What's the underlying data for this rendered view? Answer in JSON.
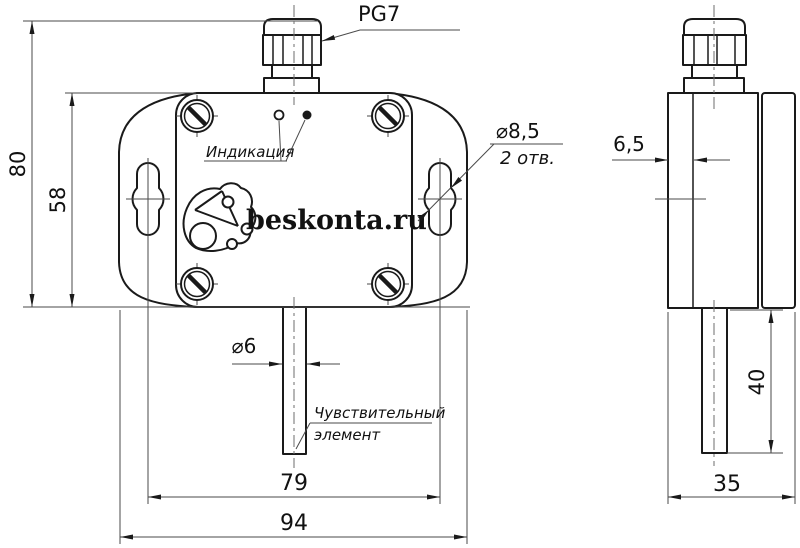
{
  "drawing": {
    "labels": {
      "cable_gland": "PG7",
      "indication": "Индикация",
      "logo_text": "beskonta.ru",
      "mount_hole_diameter": "⌀8,5",
      "mount_hole_count": "2 отв.",
      "probe_diameter": "⌀6",
      "sensing_element_line1": "Чувствительный",
      "sensing_element_line2": "элемент"
    },
    "dimensions": {
      "overall_height": "80",
      "body_height": "58",
      "mount_hole_spacing": "79",
      "overall_width": "94",
      "flange_depth": "6,5",
      "probe_length": "40",
      "overall_depth": "35"
    },
    "colors": {
      "outline": "#1a1a1a",
      "thin_line": "#4a4a4a",
      "center_line": "#6e6e6e",
      "background": "#ffffff",
      "text": "#111111"
    }
  }
}
